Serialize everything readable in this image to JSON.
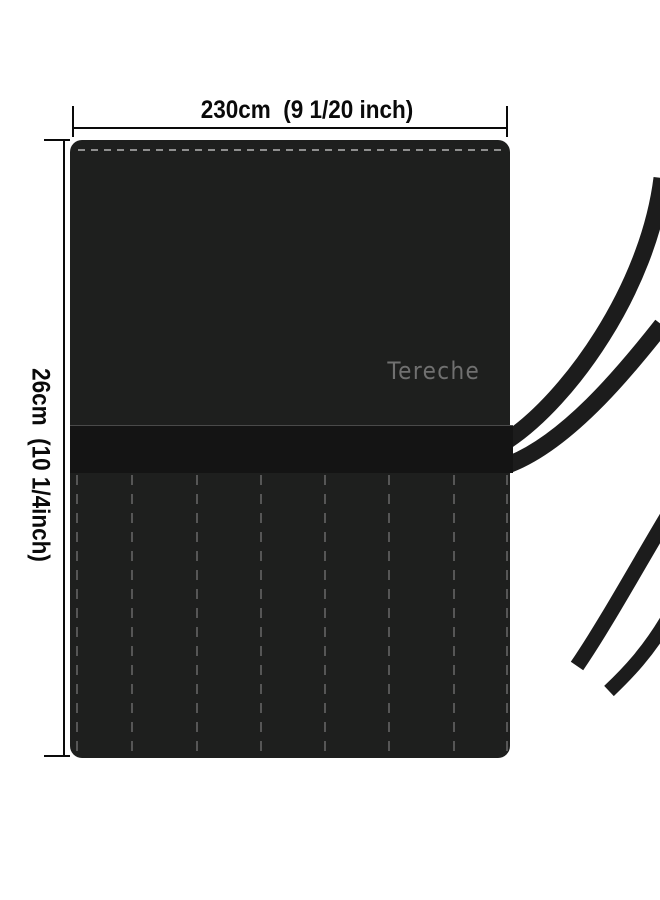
{
  "product": {
    "brand": "Tereche",
    "brand_color": "#707070",
    "body_color": "#1e1f1e",
    "band_color": "#141414",
    "strap_color": "#1c1c1c",
    "top_stitch_color": "#8f8f8f",
    "pocket_stitch_color": "#565656",
    "pocket_slot_count": 7,
    "pocket_stitch_offsets": [
      6,
      61,
      126,
      190,
      254,
      318,
      383,
      436
    ]
  },
  "dimensions": {
    "width_label": "230cm  (9 1/20 inch)",
    "height_label": "26cm  (10 1/4inch)",
    "line_color": "#0a0a0a"
  },
  "background_color": "#ffffff"
}
